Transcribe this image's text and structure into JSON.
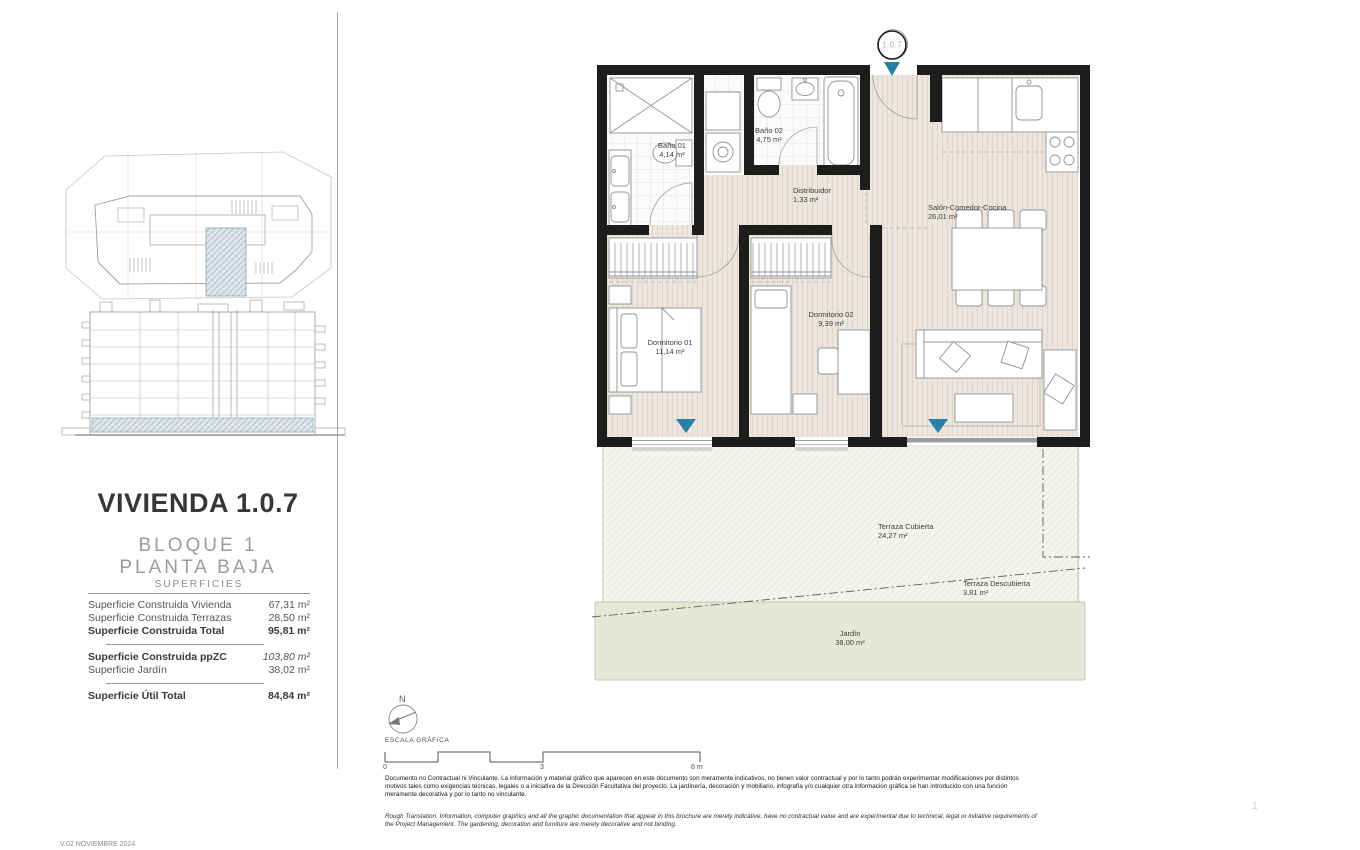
{
  "meta": {
    "version": "V.02 NOVIEMBRE 2024",
    "page_number": "1"
  },
  "sidebar": {
    "title": "VIVIENDA 1.0.7",
    "block": "BLOQUE 1",
    "floor": "PLANTA BAJA",
    "table": {
      "header": "SUPERFICIES",
      "groups": [
        {
          "rows": [
            {
              "label": "Superficie Construida Vivienda",
              "value": "67,31 m²"
            },
            {
              "label": "Superficie Construida Terrazas",
              "value": "28,50 m²"
            },
            {
              "label": "Superficie Construida Total",
              "value": "95,81 m²"
            }
          ]
        },
        {
          "rows": [
            {
              "label": "Superficie Construida ppZC",
              "value": "103,80 m²"
            },
            {
              "label": "Superficie Jardín",
              "value": "38,02 m²"
            }
          ]
        },
        {
          "rows": [
            {
              "label": "Superficie Útil Total",
              "value": "84,84 m²"
            }
          ]
        }
      ]
    }
  },
  "plan": {
    "unit_marker": "1.0.7",
    "rooms": [
      {
        "name": "Baño 01",
        "area": "4,14 m²"
      },
      {
        "name": "Baño 02",
        "area": "4,75 m²"
      },
      {
        "name": "Distribuidor",
        "area": "1,33 m²"
      },
      {
        "name": "Salón-Comedor-Cocina",
        "area": "26,01 m²"
      },
      {
        "name": "Dormitorio 01",
        "area": "11,14 m²"
      },
      {
        "name": "Dormitorio 02",
        "area": "9,39 m²"
      },
      {
        "name": "Terraza Cubierta",
        "area": "24,27 m²"
      },
      {
        "name": "Terraza Descubierta",
        "area": "3,81 m²"
      },
      {
        "name": "Jardín",
        "area": "38,00 m²"
      }
    ]
  },
  "legend": {
    "north_label": "N",
    "scale_label": "ESCALA GRÁFICA",
    "scale_ticks": [
      "0",
      "3",
      "6 m"
    ]
  },
  "disclaimer": {
    "spanish": "Documento no Contractual ni Vinculante. La información y material gráfico que aparecen en este documento son meramente indicativos, no tienen valor contractual y por lo tanto podrán experimentar modificaciones por distintos motivos tales como exigencias técnicas, legales o a iniciativa de la Dirección Facultativa del proyecto. La jardinería, decoración y mobiliario, infografía y/o cualquier otra información gráfica se han introducido con una función meramente decorativa y por lo tanto no vinculante.",
    "english": "Rough Translation. Information, computer graphics and all the graphic documentation that appear in this brochure are merely indicative, have no contractual value and are experimental due to technical, legal or initiative requirements of the Project Management. The gardening, decoration and furniture are merely decorative and not binding."
  },
  "colors": {
    "wall": "#1d1d1b",
    "accent_marker": "#2a7fa6",
    "garden_green": "#e4e9d6",
    "highlight_hatch": "#d7e2e6",
    "wood_floor": "#ece6df"
  }
}
